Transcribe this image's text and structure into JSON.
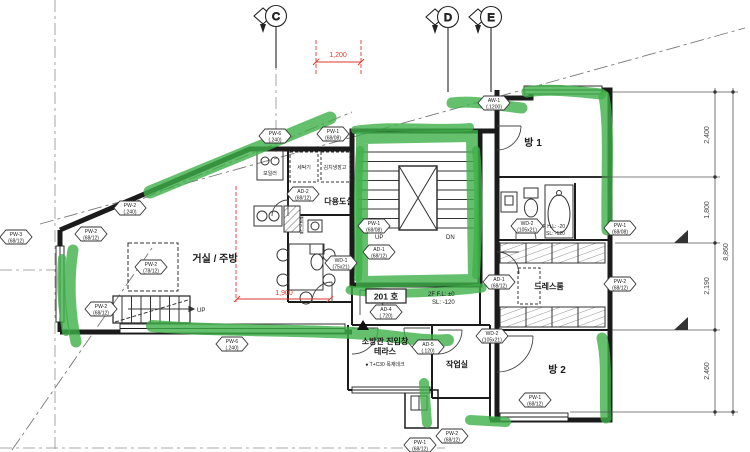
{
  "grid_bubbles": [
    {
      "label": "C"
    },
    {
      "label": "D"
    },
    {
      "label": "E"
    }
  ],
  "rooms": {
    "living": "거실 / 주방",
    "utility": "다용도실",
    "outdoor_unit": "실외기실",
    "room1": "방 1",
    "dressroom": "드레스룸",
    "room2": "방 2",
    "workroom": "작업실",
    "terrace": "테라스"
  },
  "annotations": {
    "unit_number": "201 호",
    "fireman_window": "소방관 진입창",
    "deck_note": "● T+C30 목재데크",
    "level_main_1": "2F F.L: ±0",
    "level_main_2": "SL: -120",
    "level_bath_1": "2F H.L: -20",
    "level_bath_2": "SL: -120",
    "stair_up": "UP",
    "stair_dn": "DN",
    "entry_up": "UP",
    "washer": "세탁기",
    "kimchi_fridge": "김치냉장고",
    "boiler": "보일러"
  },
  "dimensions": {
    "top_red": "1,200",
    "living_red": "1,900",
    "right": [
      "2,400",
      "1,800",
      "2,190",
      "2,460"
    ],
    "right_total": "8,860"
  },
  "wall_tags": [
    {
      "code": "PW-6",
      "size": "(.240)",
      "x": 275,
      "y": 136
    },
    {
      "code": "PW-1",
      "size": "(68/08)",
      "x": 333,
      "y": 134
    },
    {
      "code": "AW-1",
      "size": "(.1200)",
      "x": 494,
      "y": 103
    },
    {
      "code": "PW-2",
      "size": "(.240)",
      "x": 130,
      "y": 208
    },
    {
      "code": "PW-2",
      "size": "(68/12)",
      "x": 91,
      "y": 234
    },
    {
      "code": "PW-3",
      "size": "(68/12)",
      "x": 16,
      "y": 237
    },
    {
      "code": "PW-2",
      "size": "(78/12)",
      "x": 151,
      "y": 267
    },
    {
      "code": "PW-2",
      "size": "(68/12)",
      "x": 101,
      "y": 309
    },
    {
      "code": "PW-6",
      "size": "(.240)",
      "x": 232,
      "y": 344
    },
    {
      "code": "AD-2",
      "size": "(68/12)",
      "x": 303,
      "y": 194
    },
    {
      "code": "PW-1",
      "size": "(68/08)",
      "x": 374,
      "y": 226
    },
    {
      "code": "AD-1",
      "size": "(68/12)",
      "x": 379,
      "y": 252
    },
    {
      "code": "WD-1",
      "size": "(75x21)",
      "x": 341,
      "y": 263
    },
    {
      "code": "AD-4",
      "size": "(.720)",
      "x": 386,
      "y": 312
    },
    {
      "code": "AD-5",
      "size": "(.120)",
      "x": 428,
      "y": 347
    },
    {
      "code": "WD-2",
      "size": "(105x21)",
      "x": 527,
      "y": 226
    },
    {
      "code": "AD-1",
      "size": "(68/12)",
      "x": 499,
      "y": 282
    },
    {
      "code": "PW-1",
      "size": "(68/08)",
      "x": 620,
      "y": 228
    },
    {
      "code": "PW-2",
      "size": "(68/12)",
      "x": 620,
      "y": 284
    },
    {
      "code": "WD-2",
      "size": "(105x21)",
      "x": 492,
      "y": 336
    },
    {
      "code": "PW-1",
      "size": "(68/12)",
      "x": 535,
      "y": 400
    },
    {
      "code": "PW-2",
      "size": "(68/12)",
      "x": 452,
      "y": 436
    },
    {
      "code": "PW-1",
      "size": "(68/12)",
      "x": 420,
      "y": 445
    }
  ],
  "colors": {
    "highlight_green": "#3fb049",
    "dim_red": "#d93a2b",
    "line": "#1b1b1b"
  }
}
